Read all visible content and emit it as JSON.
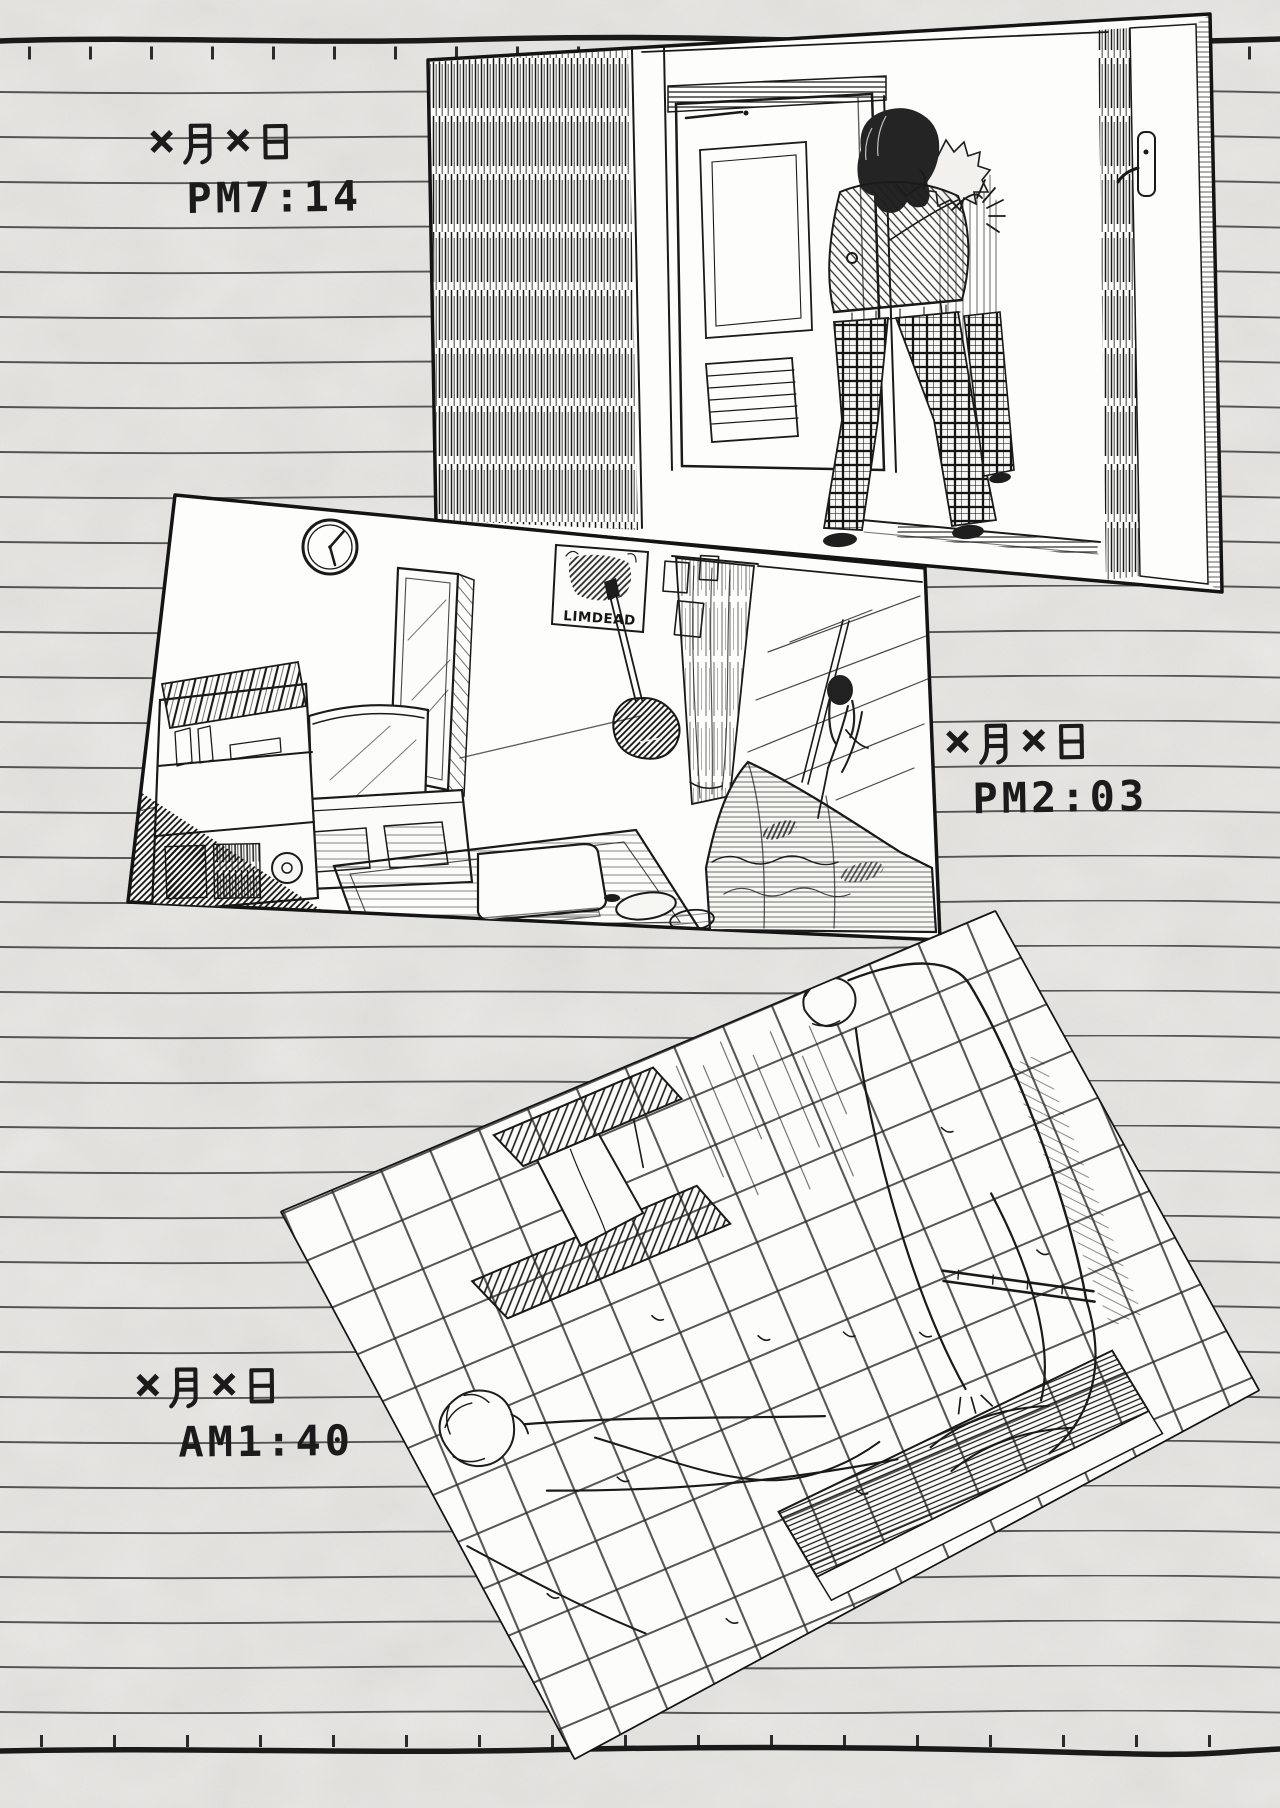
{
  "colors": {
    "paper": "#eae9e6",
    "ink": "#1a1a1a",
    "rule_line": "#3b3b3b",
    "panel_fill": "#fdfdfb"
  },
  "glyphs": {
    "cross": "×",
    "month_kanji": "月",
    "day_kanji": "日"
  },
  "entries": [
    {
      "date": "×月×日",
      "time": "PM7:14"
    },
    {
      "date": "×月×日",
      "time": "PM2:03"
    },
    {
      "date": "×月×日",
      "time": "AM1:40"
    }
  ],
  "poster": {
    "text": "LIMDEAD"
  }
}
